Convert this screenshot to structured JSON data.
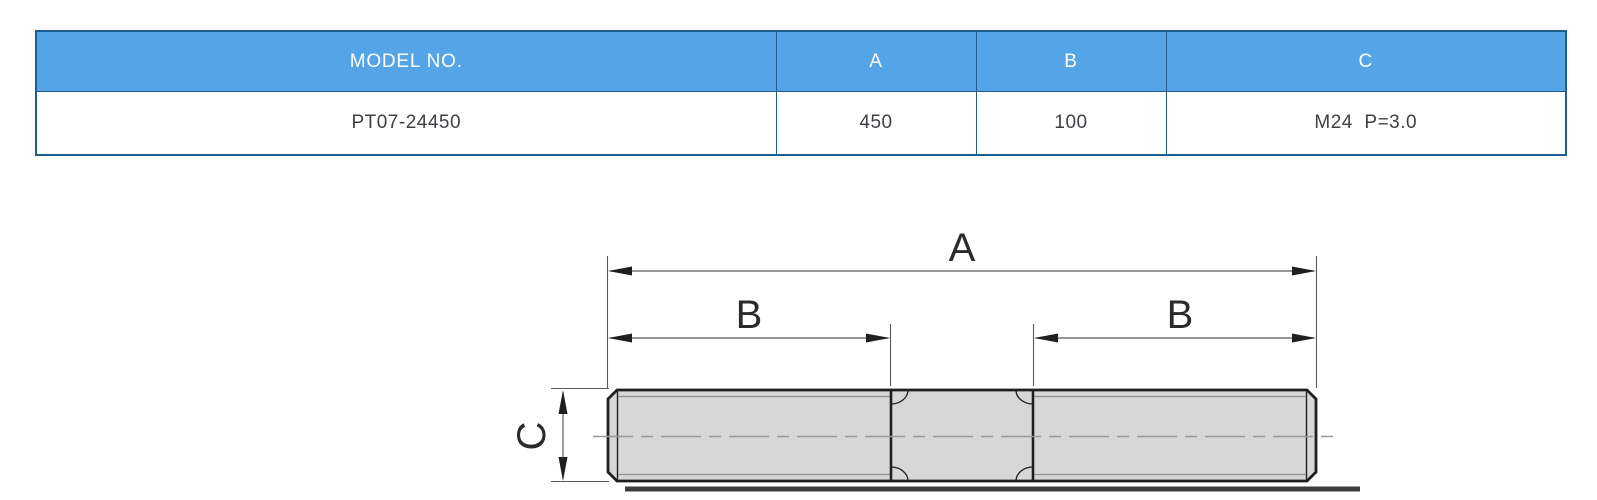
{
  "table": {
    "headers": [
      "MODEL NO.",
      "A",
      "B",
      "C"
    ],
    "rows": [
      {
        "model_no": "PT07-24450",
        "a": "450",
        "b": "100",
        "c": "M24  P=3.0"
      }
    ]
  },
  "diagram": {
    "dim_a_label": "A",
    "dim_b_left_label": "B",
    "dim_b_right_label": "B",
    "dim_c_label": "C"
  },
  "colors": {
    "header_blue": "#55a4e8",
    "border_blue": "#1e5e8e",
    "header_text": "#ffffff",
    "cell_text": "#3f4045",
    "stud_fill": "#d7d7d7",
    "stud_outline": "#1f1f1f",
    "dim_line": "#5a5a5a",
    "thread_line": "#8f8f8f",
    "centerline": "#9a9a9a",
    "label_text": "#2b2b2b"
  }
}
